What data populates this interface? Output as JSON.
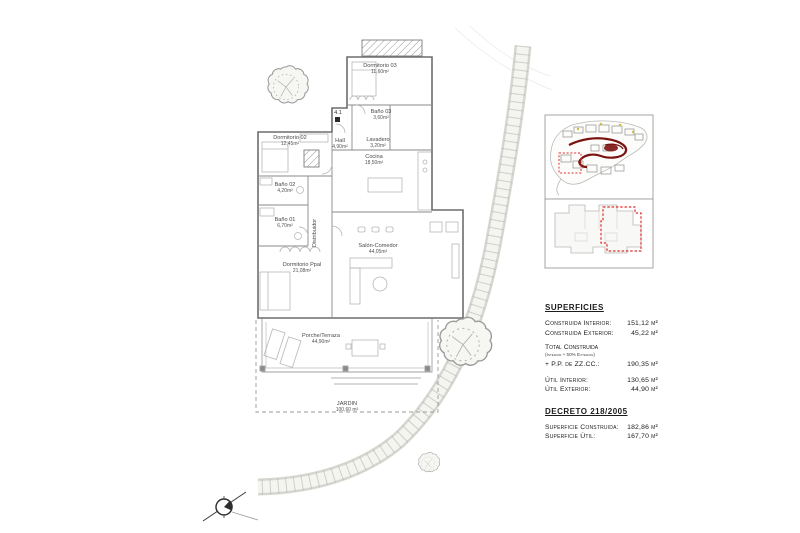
{
  "sheet": {
    "background": "#ffffff"
  },
  "colors": {
    "wall_line": "#6d6d6d",
    "partition_line": "#8a8a8a",
    "accent_red_dashed": "#e03030",
    "site_road_red": "#7b1411",
    "yellow_dot": "#d8b93c"
  },
  "floor_plan": {
    "entry_marker": "4.1",
    "rooms": [
      {
        "name": "Dormitorio 03",
        "area": "11,60m²"
      },
      {
        "name": "Baño 03",
        "area": "3,60m²"
      },
      {
        "name": "Lavadero",
        "area": "3,20m²"
      },
      {
        "name": "Hall",
        "area": "4,90m²"
      },
      {
        "name": "Cocina",
        "area": "18,50m²"
      },
      {
        "name": "Dormitorio 02",
        "area": "12,45m²"
      },
      {
        "name": "Baño 02",
        "area": "4,20m²"
      },
      {
        "name": "Baño 01",
        "area": "6,70m²"
      },
      {
        "name": "Distribuidor",
        "area": ""
      },
      {
        "name": "Dormitorio Ppal",
        "area": "21,08m²"
      },
      {
        "name": "Salón-Comedor",
        "area": "44,05m²"
      },
      {
        "name": "Porche/Terraza",
        "area": "44,90m²"
      },
      {
        "name": "JARDIN",
        "area": "100,60 m²"
      }
    ]
  },
  "surfaces": {
    "title": "SUPERFICIES",
    "rows": [
      {
        "label": "Construida Interior:",
        "value": "151,12 m²"
      },
      {
        "label": "Construida Exterior:",
        "value": "45,22 m²"
      }
    ],
    "total_label": "Total Construida",
    "total_note": "(Interior + 50% Exterior)",
    "total_row": {
      "label": "+ P.P. de ZZ.CC.:",
      "value": "190,35 m²"
    },
    "util_rows": [
      {
        "label": "Útil Interior:",
        "value": "130,65 m²"
      },
      {
        "label": "Útil Exterior:",
        "value": "44,90 m²"
      }
    ],
    "decreto_title": "DECRETO 218/2005",
    "decreto_rows": [
      {
        "label": "Superficie Construida:",
        "value": "182,86 m²"
      },
      {
        "label": "Superficie Útil:",
        "value": "167,70 m²"
      }
    ]
  }
}
